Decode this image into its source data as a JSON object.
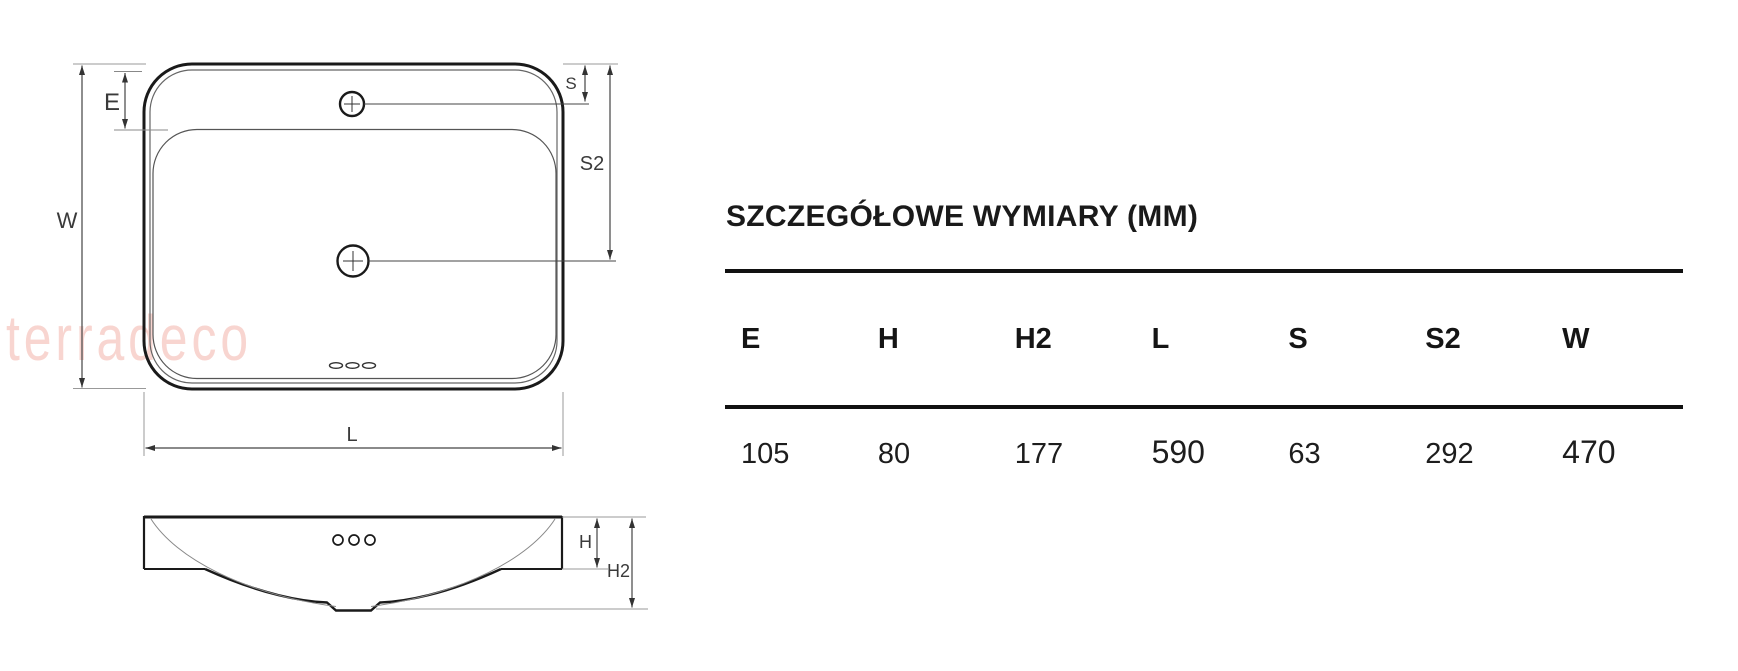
{
  "watermark": {
    "text": "terradeco"
  },
  "drawing": {
    "labels": {
      "W": "W",
      "E": "E",
      "S": "S",
      "S2": "S2",
      "L": "L",
      "H": "H",
      "H2": "H2"
    }
  },
  "panel": {
    "title": "SZCZEGÓŁOWE WYMIARY (MM)",
    "table": {
      "headers": [
        "E",
        "H",
        "H2",
        "L",
        "S",
        "S2",
        "W"
      ],
      "values": [
        "105",
        "80",
        "177",
        "590",
        "63",
        "292",
        "470"
      ]
    }
  },
  "colors": {
    "ink": "#1d1d1d",
    "table_rule": "#111111",
    "dimension_line": "#444444",
    "extension_line": "#999999",
    "watermark_pink": "#f8d5d0"
  }
}
